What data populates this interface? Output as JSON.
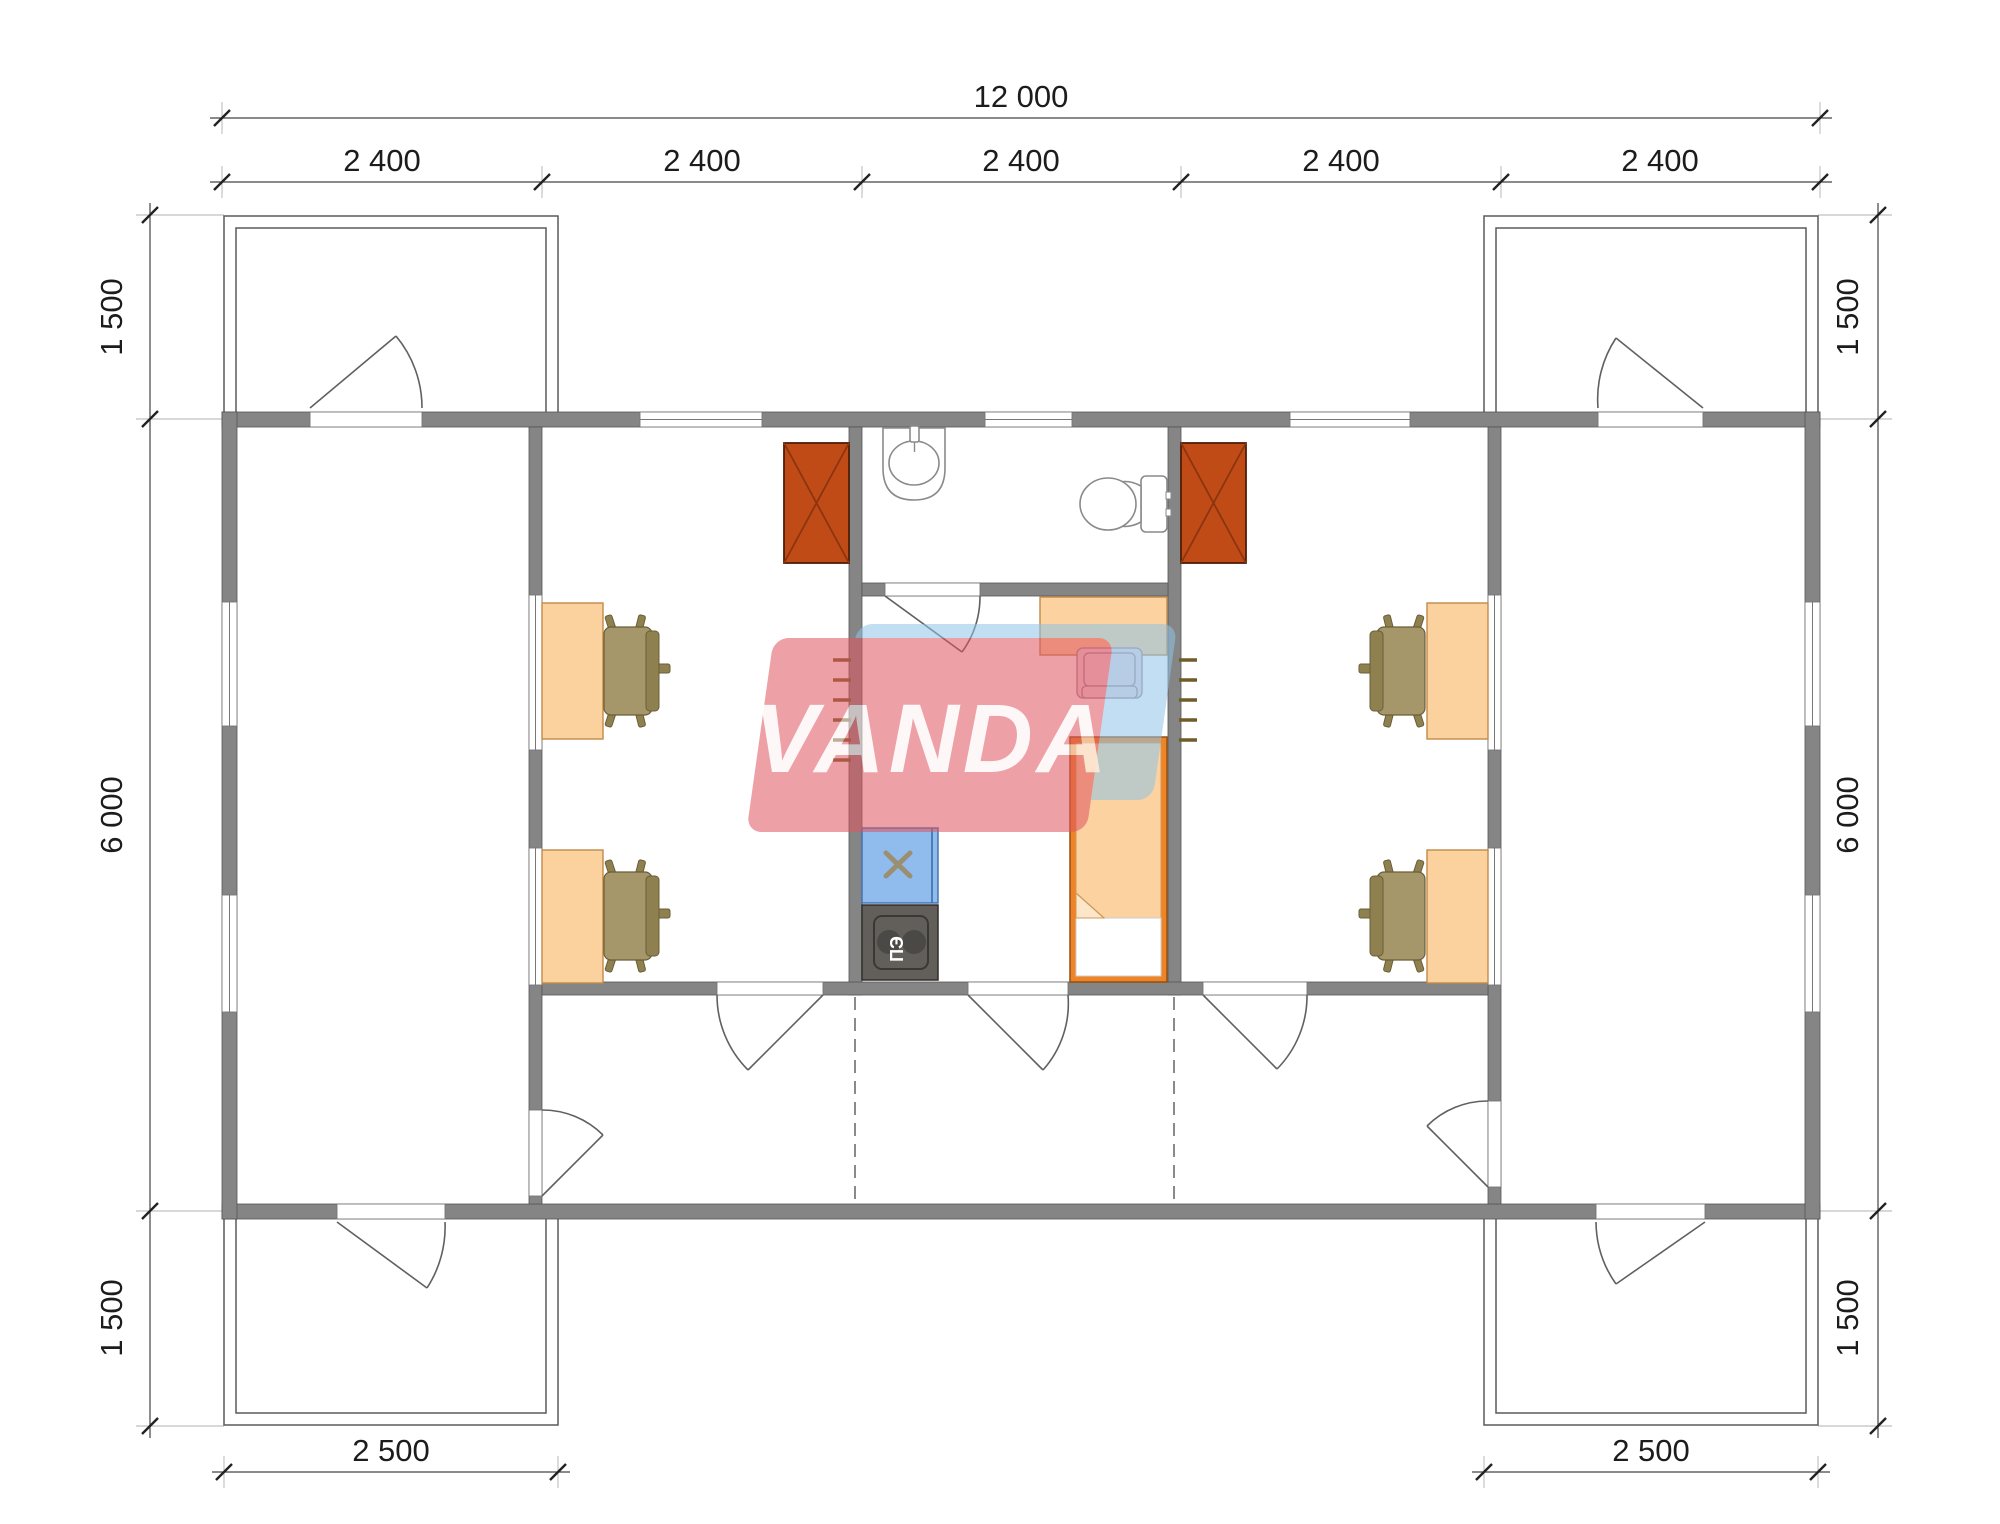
{
  "document": {
    "kind": "architectural-floor-plan",
    "background": "#ffffff"
  },
  "dimensions": {
    "top_total": "12 000",
    "top_segments": [
      "2 400",
      "2 400",
      "2 400",
      "2 400",
      "2 400"
    ],
    "left": [
      "1 500",
      "6 000",
      "1 500"
    ],
    "right": [
      "1 500",
      "6 000",
      "1 500"
    ],
    "bottom_left": "2 500",
    "bottom_right": "2 500"
  },
  "labels": {
    "electric_stove": "ПЭ"
  },
  "watermark": {
    "text": "VANDA",
    "red": "#e0545f",
    "blue": "#8fc4e8"
  },
  "colors": {
    "wall": "#858585",
    "furniture_wood": "#fbd29e",
    "office_chair": "#a59769",
    "wood_stove": "#c14b16",
    "bed_frame": "#ef8427",
    "kitchen_sink_counter": "#8fbcec",
    "electric_stove_unit": "#625f5b"
  },
  "icons": [
    "wood-stove-icon",
    "office-desk-icon",
    "office-chair-icon",
    "washbasin-icon",
    "toilet-icon",
    "kitchen-sink-icon",
    "electric-stove-icon",
    "dining-table-icon",
    "dining-chair-icon",
    "single-bed-icon",
    "loft-ladder-icon",
    "door-swing-icon",
    "window-icon",
    "porch-outline-icon"
  ]
}
